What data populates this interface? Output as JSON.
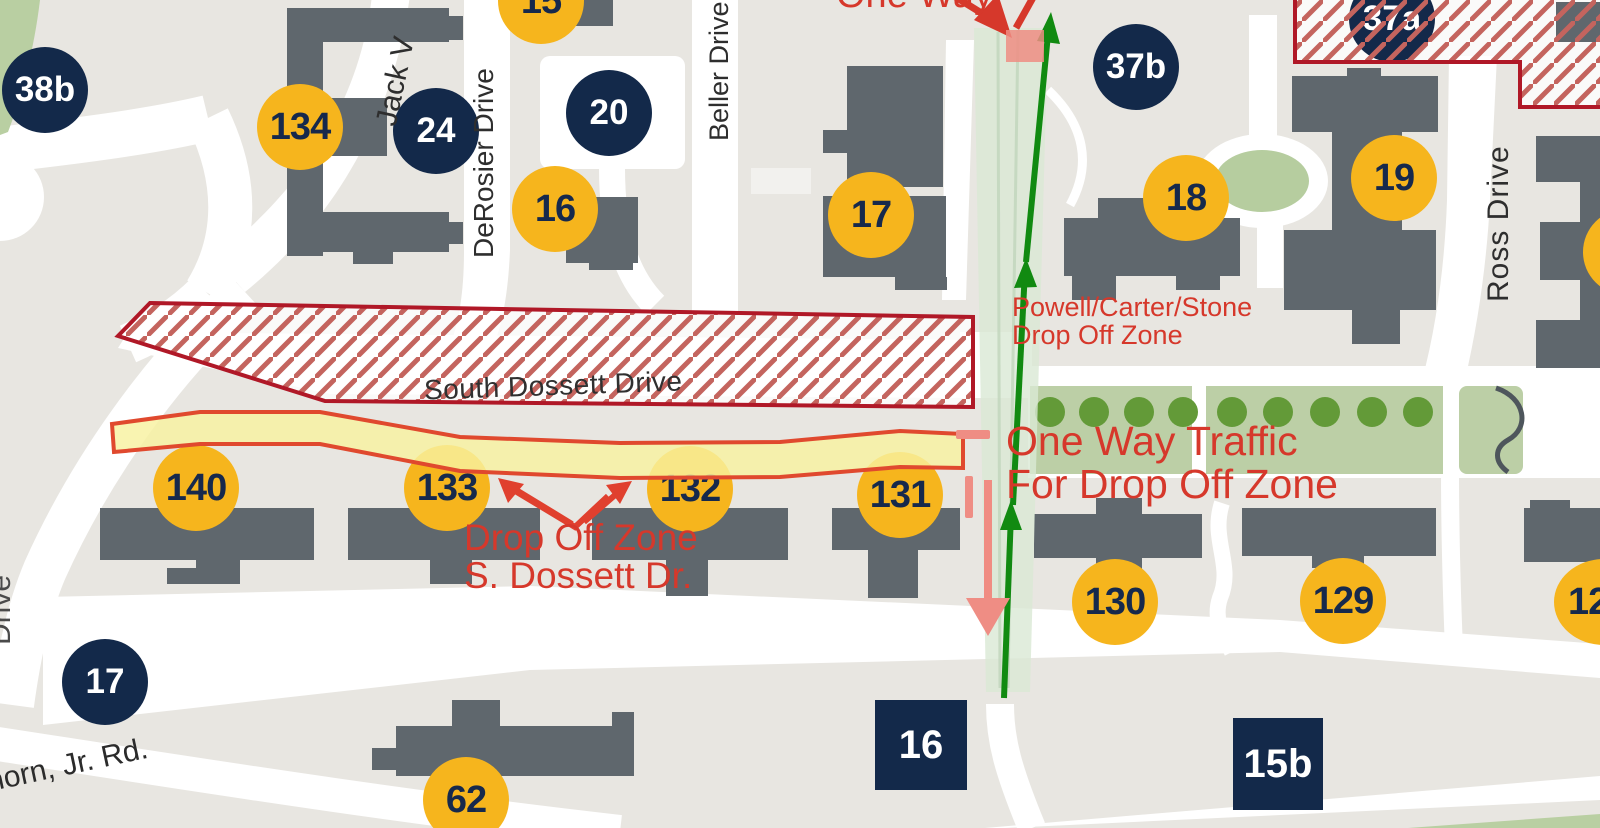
{
  "streets": {
    "jack": "Jack V",
    "derosier": "DeRosier Drive",
    "beller": "Beller Drive",
    "ross": "Ross Drive",
    "south_dossett": "South Dossett Drive",
    "vanhorn": "horn, Jr. Rd.",
    "left_edge_partial": "Drive"
  },
  "annotations": {
    "one_way": "One Way",
    "powell_dropoff_line1": "Powell/Carter/Stone",
    "powell_dropoff_line2": "Drop Off Zone",
    "one_way_traffic_line1": "One Way Traffic",
    "one_way_traffic_line2": "For Drop Off Zone",
    "dossett_dropoff_line1": "Drop Off Zone",
    "dossett_dropoff_line2": "S. Dossett Dr."
  },
  "badges": {
    "yellow_circles": [
      "15",
      "134",
      "16",
      "17",
      "18",
      "19",
      "140",
      "133",
      "132",
      "131",
      "130",
      "129",
      "12",
      "62",
      "1"
    ],
    "navy_circles": [
      "38b",
      "24",
      "20",
      "37b",
      "37a",
      "17"
    ],
    "navy_squares": [
      "16",
      "15b"
    ]
  },
  "colors": {
    "background": "#e8e6e1",
    "road_white": "#ffffff",
    "building_gray": "#5f676d",
    "badge_yellow": "#f6b51d",
    "badge_navy": "#13294a",
    "annotation_red": "#d6382b",
    "zone_border_red": "#b01827",
    "hatch_line_red": "#c4645e",
    "route_yellow": "#f8f1a0",
    "route_outline_red": "#e0492e",
    "one_way_band_green": "#d9e8d5",
    "arrow_green": "#118a11",
    "wrong_way_salmon": "#ef8d84",
    "lawn_green": "#bccfa6",
    "tree_dot_green": "#639a38"
  }
}
